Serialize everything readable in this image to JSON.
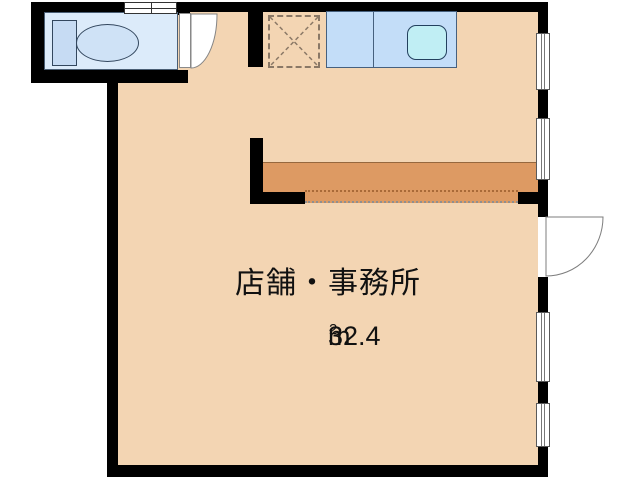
{
  "plan": {
    "room_label": "店舗・事務所",
    "area_value": "32.4",
    "area_unit": "m",
    "area_exponent": "2"
  },
  "icons": {
    "toilet": "toilet-top-view-symbol",
    "kitchen_sink": "counter-with-sink-symbol",
    "appliance_space": "dashed-box-with-cross",
    "toilet_door": "quarter-arc-swing-door",
    "entrance_door": "quarter-arc-swing-door",
    "window": "double-line-window-symbol"
  },
  "colors": {
    "floor": "#f3d5b3",
    "band": "#dd9a63",
    "kitchen": "#c3ddf8",
    "sink": "#c0eef4",
    "toilet-floor": "#dcebfa",
    "toilet-fixture": "#c6dbf3",
    "wall": "#000000"
  }
}
